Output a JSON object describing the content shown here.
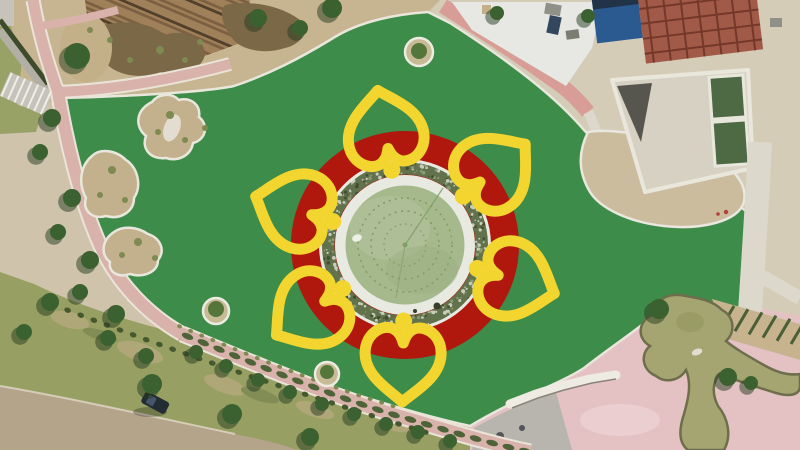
{
  "scene": {
    "kind": "aerial-drone-photo",
    "subject": "park under construction with flower-shaped fountain plaza",
    "width": 800,
    "height": 450
  },
  "palette": {
    "base_sand": "#cfc4ab",
    "nw_sand": "#c7b591",
    "mulch": "#7a6847",
    "wood": "#7d5f42",
    "wood_dark": "#52402c",
    "wood_light": "#a08059",
    "scrub_sand": "#c4b088",
    "grass_nw": "#99a266",
    "ramp_gray": "#b2afa4",
    "hedge_dark": "#3e4a2c",
    "stairs_gray": "#c5c3ba",
    "stair_line": "#efeee8",
    "paver_pink": "#d8b2ab",
    "paver_under": "#eae4d8",
    "turf": "#3e8c49",
    "turf_curb": "#e9e6dc",
    "island_sand": "#c2b18c",
    "island_edge": "#e9e7dd",
    "rock_white": "#e2ddd0",
    "tree_green": "#3b6130",
    "tree_shadow": "#263c1f",
    "ti_ring": "#ecebe2",
    "ti_sand": "#c6bb94",
    "ti_canopy": "#54763a",
    "concrete": "#d5ccb8",
    "plaza_white": "#e7e8e3",
    "red_path": "#d89d97",
    "brick": "#a15a47",
    "brick_grid": "#74382b",
    "roof_blue": "#2b5a90",
    "roof_navy": "#203349",
    "gray_block": "#8f9088",
    "gray_block_dark": "#7b7c74",
    "navy_block": "#31475e",
    "dirt": "#ccbc9e",
    "dirt_edge": "#e9e7df",
    "pool_green": "#4d6a44",
    "pool_frame": "#e9e7db",
    "struct_fill": "#d6d1c2",
    "struct_dark": "#56564e",
    "white_path": "#dcd8cb",
    "grass_band": "#97a062",
    "grass_patch": "#b4a97b",
    "grass_streak": "#7e8a52",
    "shrub_dark": "#46582f",
    "road": "#b3a48a",
    "road_edge": "#d6cdb8",
    "car_body": "#232b33",
    "car_glass": "#46566a",
    "hedge_mid": "#4e6438",
    "flower_red": "#b0180d",
    "petal_yellow": "#f2d52e",
    "ring_white": "#e8eae2",
    "veg_ring": "#62724c",
    "veg_light": "#c7cdbb",
    "veg_dark": "#40502f",
    "veg_mid": "#8a9a74",
    "water": "#a6b98c",
    "water_light": "#b2c29c",
    "water_dark": "#9ab081",
    "fountain_dot": "#829d67",
    "plaza_pink": "#e4c2c3",
    "plaza_pink_light": "#eed3d4",
    "paving_gray": "#b7b5ae",
    "paving_dot": "#54555a",
    "bench_white": "#eeebe2",
    "bench_shadow": "#8a8478",
    "pond_olive": "#a4a571",
    "pond_curb": "#6e6e4c",
    "pond_shade": "#93965e",
    "slope_soil": "#c7b48e",
    "slope_row": "#495f36",
    "white_speck": "#eef0e8",
    "dark_speck": "#343e2b",
    "red_speck": "#b04038"
  },
  "flower": {
    "center_x": 405,
    "center_y": 245,
    "red_disc_radius": 114,
    "outer_ring_radius": 84.5,
    "veg_ring_radius": 77,
    "rim_radius": 64.5,
    "water_radius": 59.5,
    "fountain_ring_radii": [
      47,
      34,
      21
    ],
    "petal_count": 6,
    "petal_angles_deg": [
      -10,
      50,
      108,
      181,
      235,
      288
    ]
  },
  "trees": [
    {
      "color_key": "tree_green",
      "shadow": true,
      "items": [
        [
          52,
          118,
          9
        ],
        [
          40,
          152,
          8
        ],
        [
          72,
          198,
          9
        ],
        [
          58,
          232,
          8
        ],
        [
          90,
          260,
          9
        ],
        [
          80,
          292,
          8
        ],
        [
          116,
          314,
          9
        ],
        [
          108,
          338,
          8
        ],
        [
          146,
          356,
          8
        ]
      ]
    },
    {
      "color_key": "tree_green",
      "shadow": true,
      "items": [
        [
          152,
          384,
          10
        ],
        [
          232,
          414,
          10
        ],
        [
          310,
          437,
          9
        ],
        [
          50,
          302,
          9
        ],
        [
          24,
          332,
          8
        ]
      ]
    },
    {
      "color_key": "tree_green",
      "shadow": true,
      "items": [
        [
          77,
          56,
          13
        ],
        [
          258,
          18,
          9
        ],
        [
          300,
          28,
          8
        ],
        [
          332,
          8,
          10
        ],
        [
          497,
          13,
          7
        ],
        [
          588,
          16,
          7
        ]
      ]
    },
    {
      "color_key": "tree_green",
      "shadow": true,
      "items": [
        [
          659,
          309,
          10
        ],
        [
          728,
          377,
          9
        ],
        [
          751,
          383,
          7
        ]
      ]
    },
    {
      "color_key": "tree_green",
      "shadow": true,
      "items": [
        [
          196,
          352,
          7
        ],
        [
          226,
          366,
          7
        ],
        [
          258,
          380,
          7
        ],
        [
          290,
          392,
          7
        ],
        [
          322,
          404,
          7
        ],
        [
          354,
          414,
          7
        ],
        [
          386,
          424,
          7
        ],
        [
          418,
          432,
          7
        ],
        [
          450,
          441,
          7
        ]
      ]
    },
    {
      "color_key": "grass_streak",
      "shadow": false,
      "items": [
        [
          170,
          115,
          4
        ],
        [
          185,
          140,
          3
        ],
        [
          158,
          132,
          3
        ],
        [
          205,
          128,
          3
        ],
        [
          112,
          170,
          4
        ],
        [
          100,
          195,
          3
        ],
        [
          125,
          200,
          3
        ],
        [
          138,
          242,
          4
        ],
        [
          155,
          258,
          3
        ],
        [
          122,
          255,
          3
        ],
        [
          110,
          40,
          3
        ],
        [
          130,
          60,
          3
        ],
        [
          160,
          50,
          4
        ],
        [
          185,
          60,
          3
        ],
        [
          200,
          42,
          3
        ],
        [
          90,
          30,
          3
        ]
      ]
    },
    {
      "color_key": "ti_canopy",
      "shadow": false,
      "items": [
        [
          419,
          51,
          8
        ],
        [
          216,
          309,
          8
        ],
        [
          327,
          372,
          7
        ]
      ]
    }
  ],
  "generated": {
    "veg_speckles": {
      "count": 260,
      "r_min": 70.5,
      "r_span": 13,
      "colors": [
        "veg_light",
        "veg_dark",
        "veg_mid",
        "veg_light"
      ]
    },
    "hedgerows": [
      {
        "path": "#bottom-path-line",
        "step": 17,
        "rx": 6,
        "ry": 3,
        "color_key": "hedge_mid"
      },
      {
        "path": "#bottom-flower-line",
        "step": 12,
        "rx": 2.5,
        "ry": 2,
        "color_key": "grass_streak"
      },
      {
        "path": "#shrub-row-line",
        "step": 14,
        "rx": 3.4,
        "ry": 2.6,
        "color_key": "shrub_dark"
      }
    ]
  }
}
